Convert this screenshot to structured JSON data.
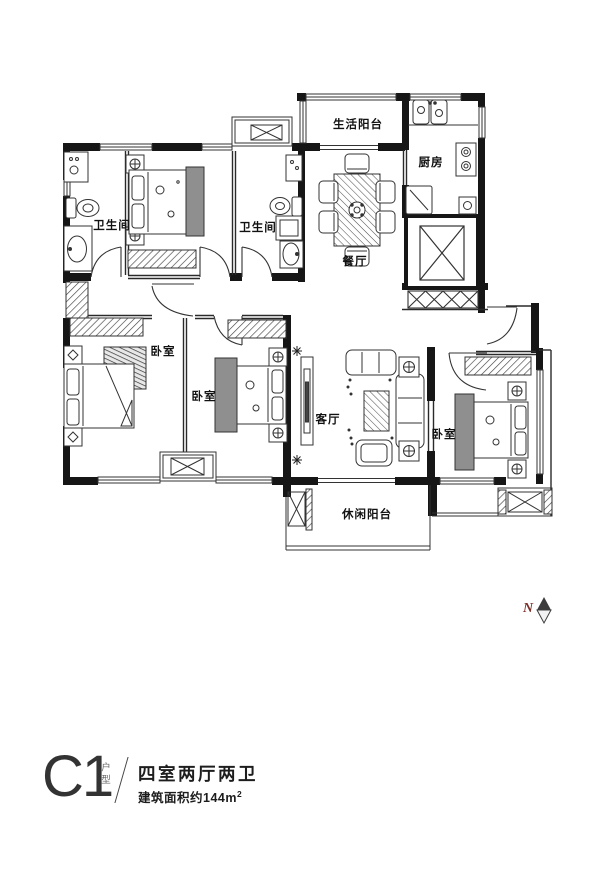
{
  "plan": {
    "rooms": {
      "life_balcony": "生活阳台",
      "kitchen": "厨房",
      "dining": "餐厅",
      "bath_left": "卫生间",
      "bath_right": "卫生间",
      "bedroom_left": "卧室",
      "bedroom_middle": "卧室",
      "bedroom_right": "卧室",
      "living": "客厅",
      "leisure_balcony": "休闲阳台"
    },
    "compass": {
      "label": "N"
    }
  },
  "title": {
    "code": "C1",
    "code_suffix": "户型",
    "headline": "四室两厅两卫",
    "area_prefix": "建筑面积约144m",
    "area_sup": "2"
  },
  "colors": {
    "ink": "#1a1a1a",
    "wardrobe_gray": "#8f8f8f",
    "compass_n": "#7b2d26"
  }
}
